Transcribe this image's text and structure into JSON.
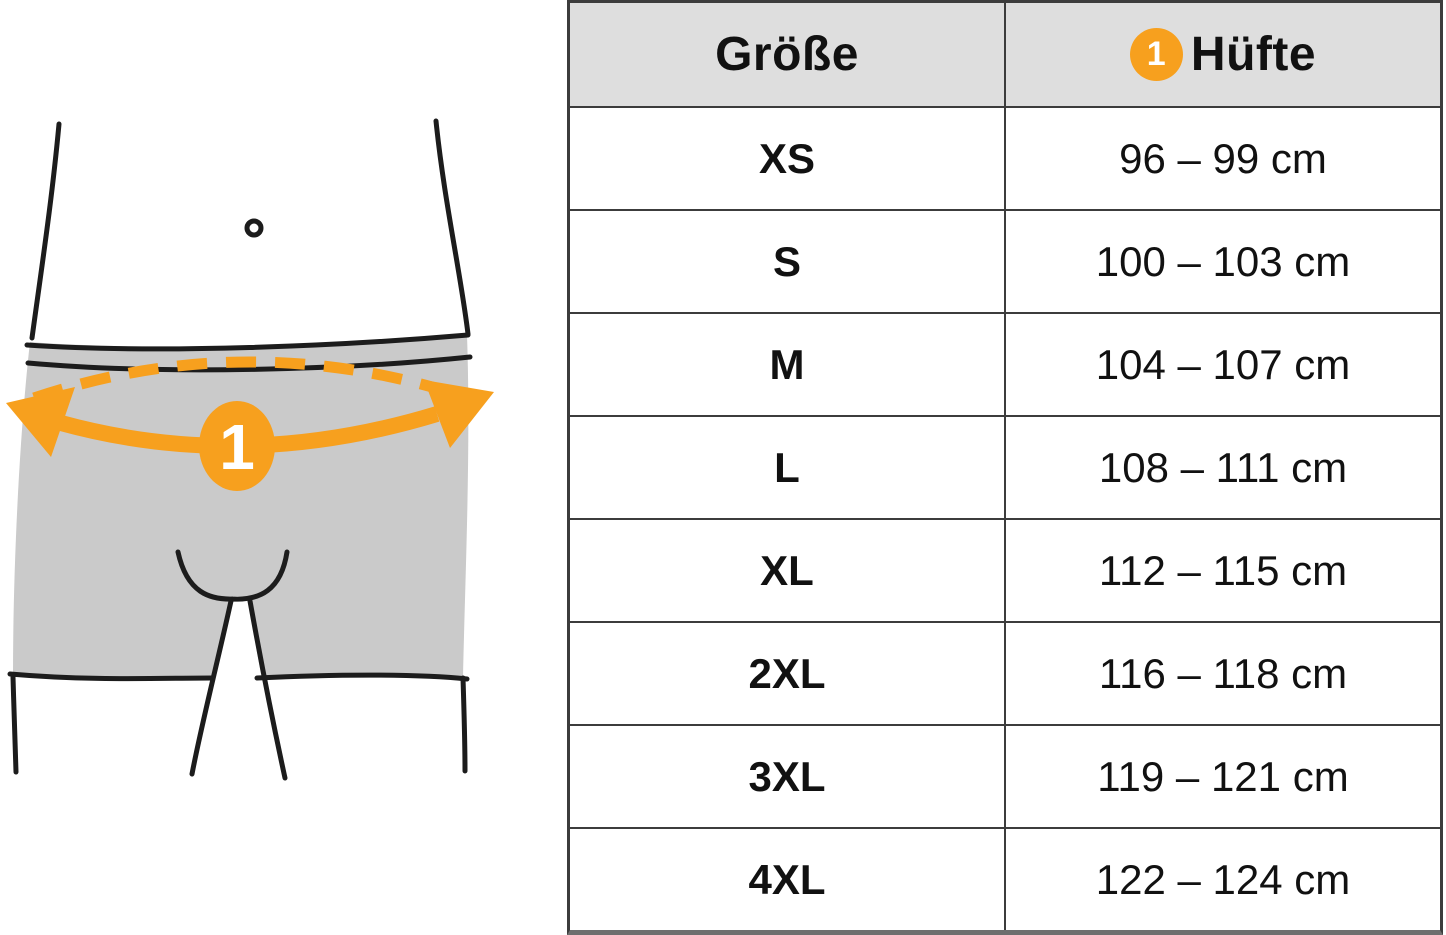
{
  "illustration": {
    "marker_label": "1",
    "accent_color": "#f7a01e",
    "shorts_fill": "#cacaca",
    "line_color": "#1c1c1c"
  },
  "table": {
    "header": {
      "size_label": "Größe",
      "marker": "1",
      "measure_label": "Hüfte"
    },
    "rows": [
      {
        "size": "XS",
        "range": "96 – 99 cm"
      },
      {
        "size": "S",
        "range": "100 – 103 cm"
      },
      {
        "size": "M",
        "range": "104 – 107 cm"
      },
      {
        "size": "L",
        "range": "108 – 111 cm"
      },
      {
        "size": "XL",
        "range": "112 – 115 cm"
      },
      {
        "size": "2XL",
        "range": "116 – 118 cm"
      },
      {
        "size": "3XL",
        "range": "119 – 121 cm"
      },
      {
        "size": "4XL",
        "range": "122 – 124 cm"
      }
    ]
  }
}
